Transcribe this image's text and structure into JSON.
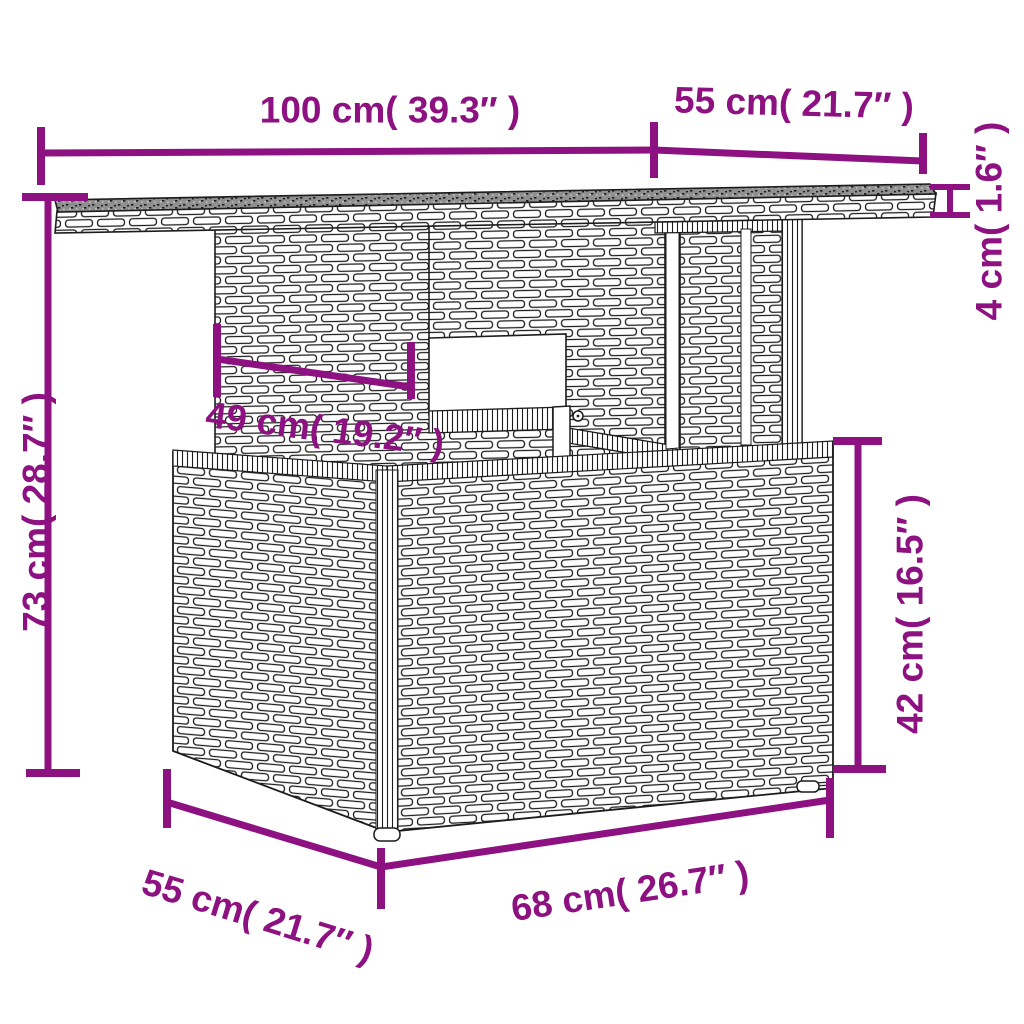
{
  "diagram": {
    "kind": "product-dimension-diagram",
    "units_shown": [
      "cm",
      "inches"
    ]
  },
  "colors": {
    "dimension_accent": "#8d1181",
    "line_art": "#1c1c1c",
    "glass_top": "#909090",
    "background": "#ffffff"
  },
  "dimensions": {
    "top_length": {
      "label": "100 cm( 39.3″ )",
      "cm": 100,
      "inches": 39.3
    },
    "top_depth": {
      "label": "55 cm( 21.7″ )",
      "cm": 55,
      "inches": 21.7
    },
    "top_thickness": {
      "label": "4 cm( 1.6″ )",
      "cm": 4,
      "inches": 1.6
    },
    "total_height": {
      "label": "73 cm( 28.7″ )",
      "cm": 73,
      "inches": 28.7
    },
    "pedestal_width": {
      "label": "49 cm( 19.2″ )",
      "cm": 49,
      "inches": 19.2
    },
    "base_height": {
      "label": "42 cm( 16.5″ )",
      "cm": 42,
      "inches": 16.5
    },
    "base_length": {
      "label": "68 cm( 26.7″ )",
      "cm": 68,
      "inches": 26.7
    },
    "base_depth": {
      "label": "55 cm( 21.7″ )",
      "cm": 55,
      "inches": 21.7
    }
  }
}
